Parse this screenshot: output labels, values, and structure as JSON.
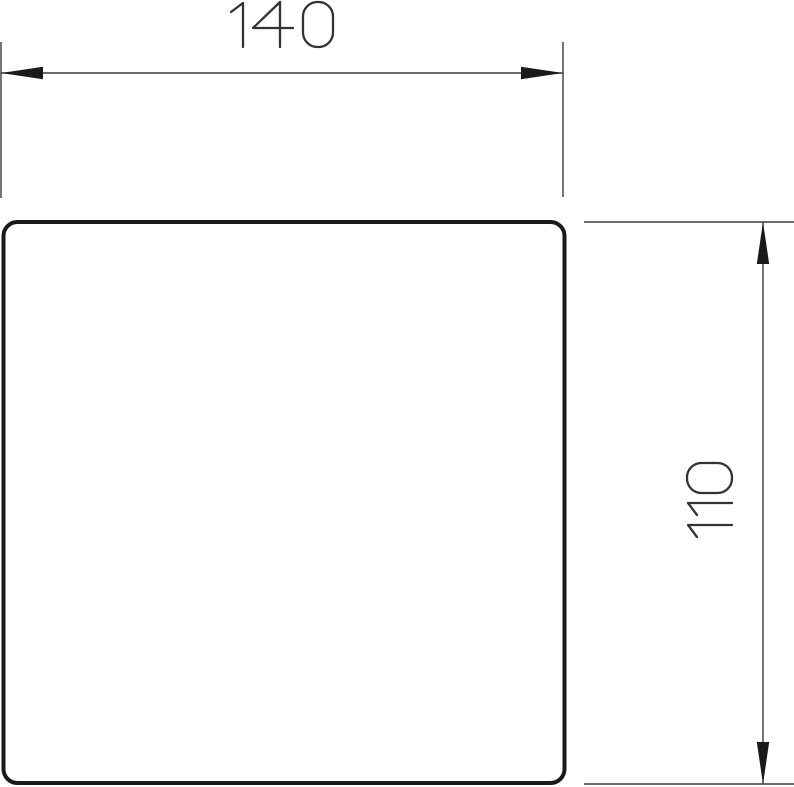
{
  "drawing": {
    "title": "Technical dimension drawing of a rounded-corner square plate",
    "part": {
      "shape": "rounded-corner square plate",
      "fill": "#ffffff",
      "outline_color": "#1a1a1a"
    },
    "dimensions": {
      "width": {
        "value": "140",
        "orientation": "horizontal",
        "position": "top"
      },
      "height": {
        "value": "110",
        "orientation": "vertical",
        "position": "right"
      }
    },
    "style": {
      "dimension_line_color": "#3d3d3d",
      "arrow_color": "#1a1a1a",
      "text_color": "#333333",
      "background_color": "#ffffff"
    }
  }
}
